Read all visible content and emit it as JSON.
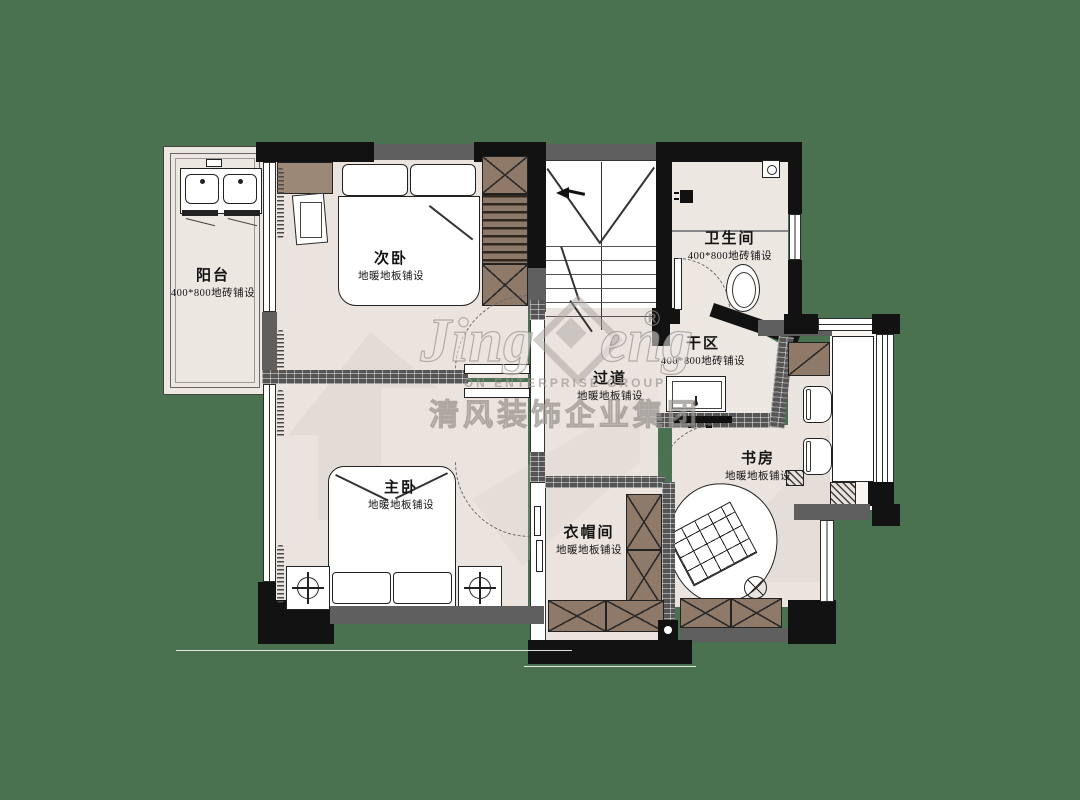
{
  "canvas": {
    "background_color": "#4A7150",
    "floor_color": "#EAE3DE",
    "wall_color": "#121212",
    "wood_color": "#8F7A6A"
  },
  "rooms": [
    {
      "key": "balcony",
      "name": "阳台",
      "finish": "400*800地砖铺设"
    },
    {
      "key": "secondary-bedroom",
      "name": "次卧",
      "finish": "地暖地板铺设"
    },
    {
      "key": "bathroom",
      "name": "卫生间",
      "finish": "400*800地砖铺设"
    },
    {
      "key": "dry-area",
      "name": "干区",
      "finish": "400*800地砖铺设"
    },
    {
      "key": "hallway",
      "name": "过道",
      "finish": "地暖地板铺设"
    },
    {
      "key": "study",
      "name": "书房",
      "finish": "地暖地板铺设"
    },
    {
      "key": "master-bedroom",
      "name": "主卧",
      "finish": "地暖地板铺设"
    },
    {
      "key": "cloakroom",
      "name": "衣帽间",
      "finish": "地暖地板铺设"
    }
  ],
  "watermark": {
    "script_left": "Jing",
    "script_right": "eng",
    "registered": "®",
    "line_en": "ON ENTERPRISE GROUP",
    "line_cn": "清风装饰企业集团"
  }
}
